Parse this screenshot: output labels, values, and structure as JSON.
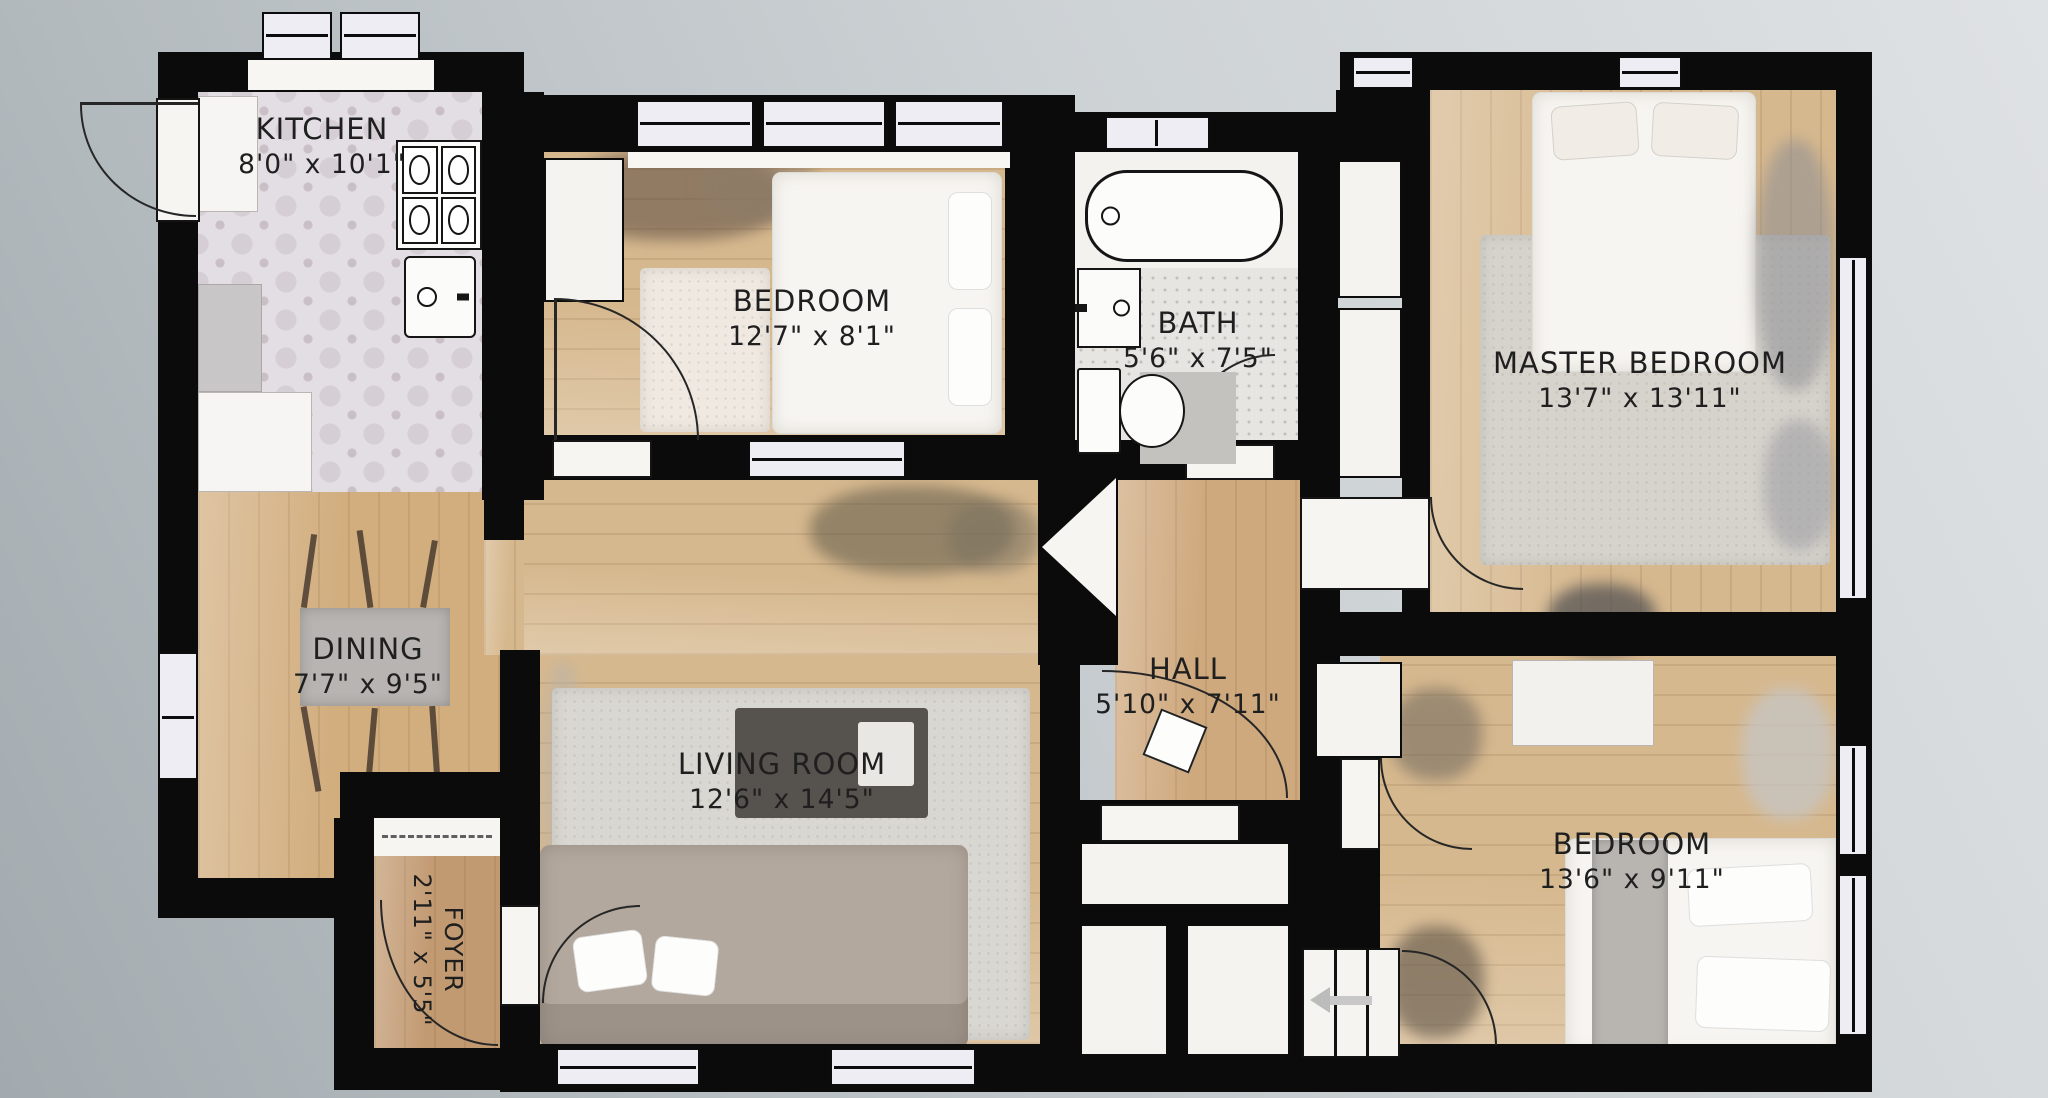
{
  "plan": {
    "type": "apartment-floor-plan",
    "rooms": [
      {
        "id": "kitchen",
        "name": "KITCHEN",
        "dims": "8'0\" x 10'1\""
      },
      {
        "id": "bedroom-top",
        "name": "BEDROOM",
        "dims": "12'7\" x 8'1\""
      },
      {
        "id": "bath",
        "name": "BATH",
        "dims": "5'6\" x 7'5\""
      },
      {
        "id": "master-bedroom",
        "name": "MASTER BEDROOM",
        "dims": "13'7\" x 13'11\""
      },
      {
        "id": "dining",
        "name": "DINING",
        "dims": "7'7\" x 9'5\""
      },
      {
        "id": "hall",
        "name": "HALL",
        "dims": "5'10\" x 7'11\""
      },
      {
        "id": "living-room",
        "name": "LIVING ROOM",
        "dims": "12'6\" x 14'5\""
      },
      {
        "id": "foyer",
        "name": "FOYER",
        "dims": "2'11\" x 5'5\""
      },
      {
        "id": "bedroom-bottom",
        "name": "BEDROOM",
        "dims": "13'6\" x 9'11\""
      }
    ],
    "fixtures": [
      "bathtub",
      "bathroom-sink",
      "toilet",
      "stove",
      "kitchen-sink",
      "dining-table",
      "sofa",
      "coffee-table",
      "bed",
      "rug",
      "stairs",
      "stairs-direction-arrow-left",
      "closet",
      "window",
      "door-swing",
      "dashed-threshold",
      "angled-opening",
      "light-fixture"
    ],
    "colors": {
      "background_light": "#dfe2e4",
      "background_dark": "#a2aaaf",
      "wall": "#0b0b0b",
      "wood_floor": "#d6b88e",
      "kitchen_tile": "#e2dee3",
      "bath_tile": "#e7e5e2",
      "rug_gray": "#d9d7d1",
      "white_fixture": "#f5f4f2",
      "label_text": "#1f1f1f"
    }
  }
}
